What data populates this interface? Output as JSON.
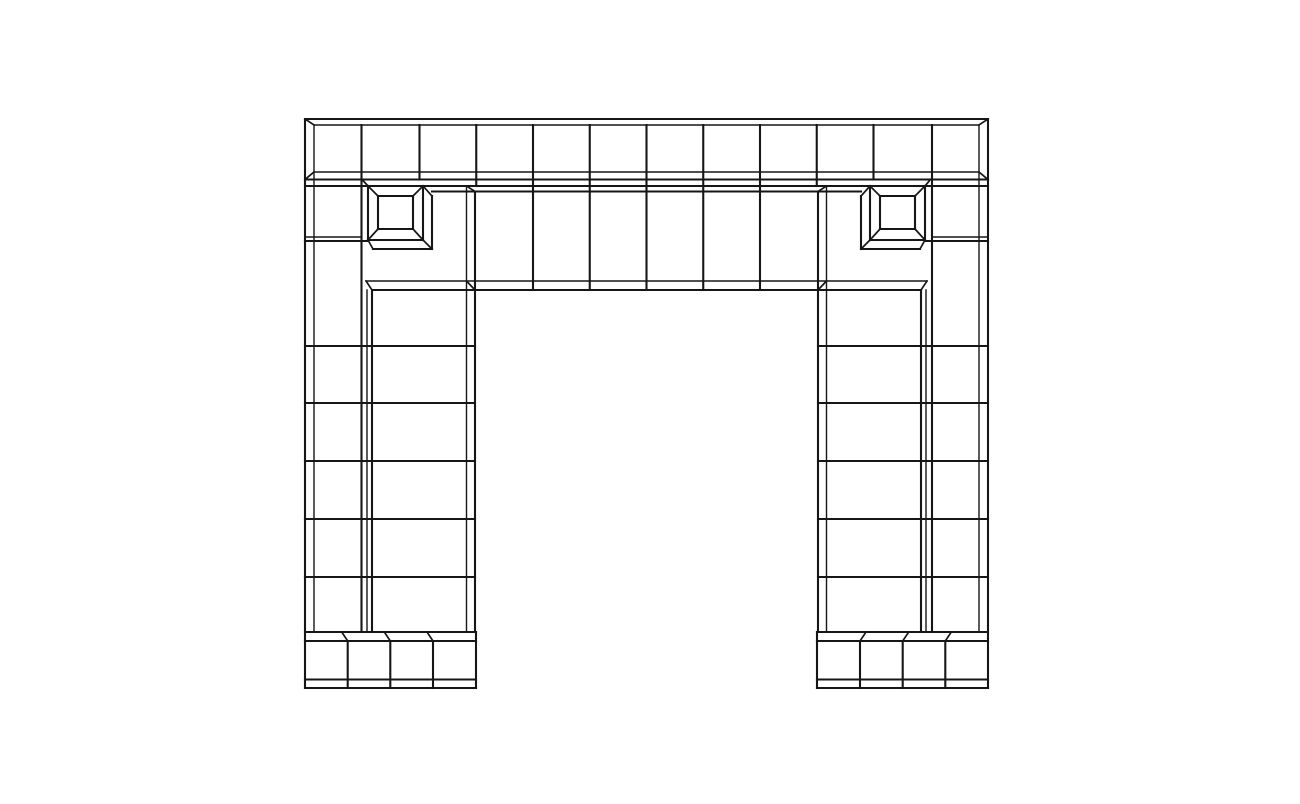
{
  "scene": {
    "description": "Black wireframe line drawing of a rectangular post-and-lintel portal built from square blocks, with two beveled square rosettes on the lintel, a recessed six-cell lintel panel, two block pillars and stepped plinth bases, centered on a white canvas",
    "background_color": "#ffffff",
    "line_color": "#161616",
    "canvas": {
      "width": 1300,
      "height": 804
    },
    "structure": {
      "top_row_squares": 12,
      "lintel_panel_cells": 6,
      "rosettes": 2,
      "pillar_block_rows": 6,
      "plinth_cells": 4
    }
  },
  "wireframe": {
    "stroke_widths": {
      "front": 2.1,
      "back": 1.4,
      "bevel": 1.7
    },
    "front_segments": [
      [
        305,
        119,
        988,
        119
      ],
      [
        305,
        179.5,
        988,
        179.5
      ],
      [
        305,
        186,
        988,
        186
      ],
      [
        432,
        191.5,
        861,
        191.5
      ],
      [
        372,
        290,
        921,
        290
      ],
      [
        305,
        241,
        368,
        241
      ],
      [
        925,
        241,
        988,
        241
      ],
      [
        305,
        346,
        475,
        346
      ],
      [
        305,
        403,
        475,
        403
      ],
      [
        305,
        461,
        475,
        461
      ],
      [
        305,
        519,
        475,
        519
      ],
      [
        305,
        577,
        475,
        577
      ],
      [
        818,
        346,
        988,
        346
      ],
      [
        818,
        403,
        988,
        403
      ],
      [
        818,
        461,
        988,
        461
      ],
      [
        818,
        519,
        988,
        519
      ],
      [
        818,
        577,
        988,
        577
      ],
      [
        305,
        632,
        476,
        632
      ],
      [
        305,
        641,
        476,
        641
      ],
      [
        305,
        679.5,
        476,
        679.5
      ],
      [
        305,
        688,
        476,
        688
      ],
      [
        817,
        632,
        988,
        632
      ],
      [
        817,
        641,
        988,
        641
      ],
      [
        817,
        679.5,
        988,
        679.5
      ],
      [
        817,
        688,
        988,
        688
      ],
      [
        305,
        119,
        305,
        688
      ],
      [
        988,
        119,
        988,
        688
      ],
      [
        361.5,
        125,
        361.5,
        632
      ],
      [
        932,
        125,
        932,
        632
      ],
      [
        372,
        290,
        372,
        632
      ],
      [
        921,
        290,
        921,
        632
      ],
      [
        475,
        191.5,
        475,
        632
      ],
      [
        818,
        191.5,
        818,
        632
      ],
      [
        419.5,
        125,
        419.5,
        179.5
      ],
      [
        873.5,
        125,
        873.5,
        179.5
      ],
      [
        476.25,
        125,
        476.25,
        186
      ],
      [
        816.75,
        125,
        816.75,
        186
      ],
      [
        533,
        125,
        533,
        290
      ],
      [
        589.75,
        125,
        589.75,
        290
      ],
      [
        646.5,
        125,
        646.5,
        290
      ],
      [
        703.25,
        125,
        703.25,
        290
      ],
      [
        760,
        125,
        760,
        290
      ],
      [
        347.7,
        641,
        347.7,
        688
      ],
      [
        390.3,
        641,
        390.3,
        688
      ],
      [
        433,
        641,
        433,
        688
      ],
      [
        860,
        641,
        860,
        688
      ],
      [
        902.7,
        641,
        902.7,
        688
      ],
      [
        945.3,
        641,
        945.3,
        688
      ],
      [
        476,
        632,
        476,
        688
      ],
      [
        817,
        632,
        817,
        688
      ],
      [
        368,
        186,
        423,
        186
      ],
      [
        368,
        240,
        423,
        240
      ],
      [
        368,
        186,
        368,
        240
      ],
      [
        423,
        186,
        423,
        240
      ],
      [
        378,
        196,
        413,
        196
      ],
      [
        378,
        229,
        413,
        229
      ],
      [
        378,
        196,
        378,
        229
      ],
      [
        413,
        196,
        413,
        229
      ],
      [
        432,
        196,
        432,
        249
      ],
      [
        373,
        249,
        432,
        249
      ],
      [
        870,
        186,
        925,
        186
      ],
      [
        870,
        240,
        925,
        240
      ],
      [
        870,
        186,
        870,
        240
      ],
      [
        925,
        186,
        925,
        240
      ],
      [
        880,
        196,
        915,
        196
      ],
      [
        880,
        229,
        915,
        229
      ],
      [
        880,
        196,
        880,
        229
      ],
      [
        915,
        196,
        915,
        229
      ],
      [
        861,
        196,
        861,
        249
      ],
      [
        861,
        249,
        920,
        249
      ]
    ],
    "back_segments": [
      [
        314,
        125,
        979,
        125
      ],
      [
        314,
        172,
        979,
        172
      ],
      [
        366,
        281,
        927,
        281
      ],
      [
        314,
        125,
        314,
        632
      ],
      [
        979,
        125,
        979,
        632
      ],
      [
        367,
        290,
        367,
        632
      ],
      [
        926,
        290,
        926,
        632
      ],
      [
        466.5,
        186,
        466.5,
        632
      ],
      [
        826.5,
        186,
        826.5,
        632
      ],
      [
        305,
        237,
        361.5,
        237
      ],
      [
        932,
        237,
        988,
        237
      ]
    ],
    "bevel_segments": [
      [
        305,
        119,
        314,
        125
      ],
      [
        988,
        119,
        979,
        125
      ],
      [
        314,
        172,
        305,
        179.5
      ],
      [
        979,
        172,
        988,
        179.5
      ],
      [
        362,
        179.5,
        368,
        186
      ],
      [
        930.5,
        179.5,
        925,
        186
      ],
      [
        466.5,
        186,
        475,
        191.5
      ],
      [
        826.5,
        186,
        818,
        191.5
      ],
      [
        466.5,
        281,
        475,
        290
      ],
      [
        826.5,
        281,
        818,
        290
      ],
      [
        366,
        281,
        372,
        290
      ],
      [
        927,
        281,
        921,
        290
      ],
      [
        368,
        186,
        378,
        196
      ],
      [
        423,
        186,
        413,
        196
      ],
      [
        368,
        240,
        378,
        229
      ],
      [
        423,
        240,
        413,
        229
      ],
      [
        423,
        186,
        432,
        196
      ],
      [
        423,
        240,
        432,
        249
      ],
      [
        368,
        240,
        373,
        249
      ],
      [
        870,
        186,
        880,
        196
      ],
      [
        925,
        186,
        915,
        196
      ],
      [
        870,
        240,
        880,
        229
      ],
      [
        925,
        240,
        915,
        229
      ],
      [
        870,
        186,
        861,
        196
      ],
      [
        870,
        240,
        861,
        249
      ],
      [
        925,
        240,
        920,
        249
      ],
      [
        341.7,
        632,
        347.7,
        641
      ],
      [
        384.3,
        632,
        390.3,
        641
      ],
      [
        427,
        632,
        433,
        641
      ],
      [
        951.3,
        632,
        945.3,
        641
      ],
      [
        908.7,
        632,
        902.7,
        641
      ],
      [
        866,
        632,
        860,
        641
      ]
    ]
  }
}
